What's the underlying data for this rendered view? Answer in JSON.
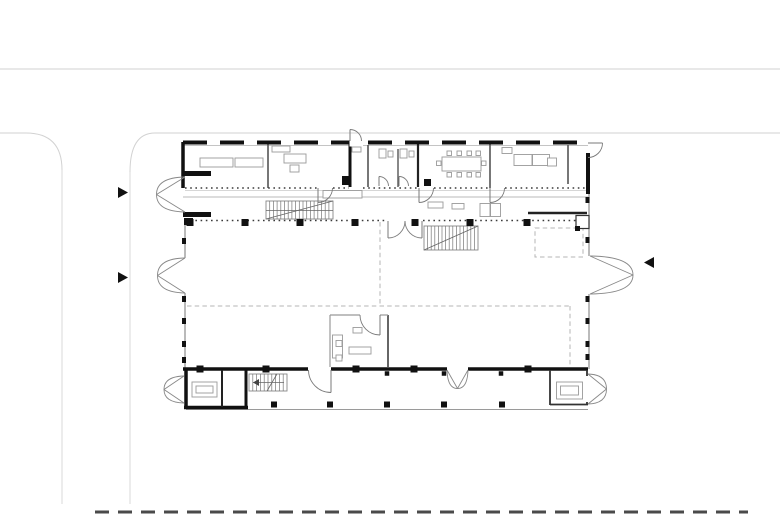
{
  "meta": {
    "kind": "architectural-floor-plan",
    "canvas": {
      "width": 780,
      "height": 515,
      "background": "#ffffff"
    },
    "colors": {
      "wall_black": "#111111",
      "wall_dark": "#222222",
      "wall_medium": "#555555",
      "wall_thin": "#8d8d8d",
      "line_light": "#b8b8b8",
      "site_line": "#d2d2d2",
      "guide_dash": "#b5b5b5",
      "door_line": "#7a7a7a",
      "furniture_line": "#9a9a9a",
      "site_dash_dark": "#4a4a4a"
    }
  },
  "site": {
    "lines": [
      {
        "n": "road-edge-top",
        "x1": 0,
        "y1": 69,
        "x2": 780,
        "y2": 69,
        "w": 1,
        "c": "#d2d2d2"
      },
      {
        "n": "road-edge-lower-left",
        "x1": 0,
        "y1": 133,
        "x2": 26,
        "y2": 133,
        "w": 1,
        "c": "#d2d2d2"
      },
      {
        "n": "road-edge-lower-right",
        "x1": 155,
        "y1": 133,
        "x2": 780,
        "y2": 133,
        "w": 1,
        "c": "#d2d2d2"
      },
      {
        "n": "driveway-edge-left",
        "x1": 62,
        "y1": 170,
        "x2": 62,
        "y2": 504,
        "w": 1,
        "c": "#d8d8d8"
      },
      {
        "n": "driveway-edge-right",
        "x1": 130,
        "y1": 172,
        "x2": 130,
        "y2": 504,
        "w": 1,
        "c": "#d8d8d8"
      }
    ],
    "curves": [
      {
        "n": "road-fillet-left",
        "d": "M26,133 Q62,133 62,170",
        "c": "#d2d2d2",
        "w": 1
      },
      {
        "n": "road-fillet-right",
        "d": "M155,133 Q130,133 130,172",
        "c": "#d2d2d2",
        "w": 1
      }
    ],
    "dashes": [
      {
        "n": "site-boundary-dashed",
        "x1": 95,
        "y1": 512,
        "x2": 748,
        "y2": 512,
        "w": 3,
        "c": "#4a4a4a",
        "dash": "14 9"
      }
    ]
  },
  "arrows": [
    {
      "n": "entrance-arrow-left-upper",
      "pts": "118,187 118,198 128,192.5"
    },
    {
      "n": "entrance-arrow-left-lower",
      "pts": "118,272 118,283 128,277.5"
    },
    {
      "n": "entrance-arrow-right",
      "pts": "654,257 654,268 644,262.5"
    }
  ],
  "plan": {
    "guides": [
      {
        "n": "void-guide-h",
        "x1": 187,
        "y1": 306,
        "x2": 570,
        "y2": 306
      },
      {
        "n": "void-guide-v",
        "x1": 380,
        "y1": 222,
        "x2": 380,
        "y2": 306
      },
      {
        "n": "void-guide-v2",
        "x1": 570,
        "y1": 306,
        "x2": 570,
        "y2": 368
      }
    ],
    "guide_rects": [
      {
        "n": "void-guide-rect",
        "x": 535,
        "y": 228,
        "w": 48,
        "h": 29
      }
    ],
    "thin_walls": [
      {
        "n": "facade-west-upper",
        "x1": 185,
        "y1": 218,
        "x2": 185,
        "y2": 258,
        "w": 1.2,
        "c": "#8d8d8d"
      },
      {
        "n": "facade-west-lower",
        "x1": 185,
        "y1": 293,
        "x2": 185,
        "y2": 369,
        "w": 1.2,
        "c": "#8d8d8d"
      },
      {
        "n": "facade-east-upper",
        "x1": 589,
        "y1": 194,
        "x2": 589,
        "y2": 256,
        "w": 1.2,
        "c": "#8d8d8d"
      },
      {
        "n": "facade-east-lower",
        "x1": 589,
        "y1": 294,
        "x2": 589,
        "y2": 369,
        "w": 1.2,
        "c": "#8d8d8d"
      },
      {
        "n": "wing-inner-face",
        "x1": 183,
        "y1": 145.5,
        "x2": 588,
        "y2": 145.5,
        "w": 0.8,
        "c": "#b0b0b0"
      },
      {
        "n": "wing-sill-line",
        "x1": 185,
        "y1": 190.5,
        "x2": 587,
        "y2": 190.5,
        "w": 0.7,
        "c": "#c8c8c8"
      },
      {
        "n": "gallery-edge",
        "x1": 183,
        "y1": 197,
        "x2": 588,
        "y2": 197,
        "w": 0.9,
        "c": "#b8b8b8"
      },
      {
        "n": "porch-edge",
        "x1": 186,
        "y1": 409.5,
        "x2": 588,
        "y2": 409.5,
        "w": 1,
        "c": "#9a9a9a"
      }
    ],
    "medium_walls": [
      {
        "n": "wing-partition-1",
        "x1": 268,
        "y1": 144,
        "x2": 268,
        "y2": 188,
        "w": 1.6,
        "c": "#555555"
      },
      {
        "n": "wc-partition-1",
        "x1": 368,
        "y1": 145,
        "x2": 368,
        "y2": 187,
        "w": 1.6,
        "c": "#555555"
      },
      {
        "n": "wc-partition-2",
        "x1": 398,
        "y1": 149,
        "x2": 398,
        "y2": 187,
        "w": 1.4,
        "c": "#555555"
      },
      {
        "n": "wing-partition-2",
        "x1": 490,
        "y1": 144,
        "x2": 490,
        "y2": 188,
        "w": 1.6,
        "c": "#555555"
      },
      {
        "n": "wing-partition-3",
        "x1": 568,
        "y1": 145,
        "x2": 568,
        "y2": 184,
        "w": 1.6,
        "c": "#555555"
      },
      {
        "n": "hall-office-wall-right",
        "x1": 388,
        "y1": 315,
        "x2": 388,
        "y2": 367,
        "w": 1.8,
        "c": "#555555"
      },
      {
        "n": "hall-office-wall-left",
        "x1": 330,
        "y1": 315,
        "x2": 330,
        "y2": 367,
        "w": 1.2,
        "c": "#999999"
      },
      {
        "n": "hall-office-wall-top-a",
        "x1": 330,
        "y1": 315,
        "x2": 360,
        "y2": 315,
        "w": 1.2,
        "c": "#999999"
      },
      {
        "n": "hall-office-wall-top-b",
        "x1": 380,
        "y1": 315,
        "x2": 388,
        "y2": 315,
        "w": 1.2,
        "c": "#999999"
      }
    ],
    "thick_walls": [
      {
        "n": "wing-west-wall",
        "x1": 183,
        "y1": 142,
        "x2": 183,
        "y2": 188,
        "w": 3.5,
        "c": "#111111"
      },
      {
        "n": "lobby-wall",
        "x1": 350,
        "y1": 142,
        "x2": 350,
        "y2": 187,
        "w": 3,
        "c": "#111111"
      },
      {
        "n": "core-wall",
        "x1": 418,
        "y1": 142,
        "x2": 418,
        "y2": 187,
        "w": 2.2,
        "c": "#222222"
      },
      {
        "n": "wing-east-wall",
        "x1": 588,
        "y1": 153,
        "x2": 588,
        "y2": 194,
        "w": 4,
        "c": "#111111"
      },
      {
        "n": "west-stub-upper",
        "x1": 183,
        "y1": 173.5,
        "x2": 211,
        "y2": 173.5,
        "w": 5,
        "c": "#111111"
      },
      {
        "n": "west-stub-lower",
        "x1": 183,
        "y1": 214.5,
        "x2": 211,
        "y2": 214.5,
        "w": 5,
        "c": "#111111"
      },
      {
        "n": "reception-wall",
        "x1": 528,
        "y1": 213,
        "x2": 587,
        "y2": 213,
        "w": 2.5,
        "c": "#222222"
      },
      {
        "n": "south-wall-a",
        "x1": 183,
        "y1": 369,
        "x2": 308,
        "y2": 369,
        "w": 3.5,
        "c": "#111111"
      },
      {
        "n": "south-wall-b",
        "x1": 331,
        "y1": 369,
        "x2": 447,
        "y2": 369,
        "w": 3.5,
        "c": "#111111"
      },
      {
        "n": "south-wall-c",
        "x1": 468,
        "y1": 369,
        "x2": 588,
        "y2": 369,
        "w": 3.5,
        "c": "#111111"
      },
      {
        "n": "bl-room-west",
        "x1": 186,
        "y1": 369,
        "x2": 186,
        "y2": 409,
        "w": 3.5,
        "c": "#111111"
      },
      {
        "n": "bl-room-south",
        "x1": 184,
        "y1": 407.5,
        "x2": 248,
        "y2": 407.5,
        "w": 3.5,
        "c": "#111111"
      },
      {
        "n": "bl-room-east",
        "x1": 246,
        "y1": 369,
        "x2": 246,
        "y2": 409,
        "w": 3,
        "c": "#111111"
      },
      {
        "n": "bl-room-divider",
        "x1": 222,
        "y1": 370,
        "x2": 222,
        "y2": 407,
        "w": 2,
        "c": "#222222"
      },
      {
        "n": "br-room-west",
        "x1": 550,
        "y1": 370,
        "x2": 550,
        "y2": 405,
        "w": 1.8,
        "c": "#333333"
      },
      {
        "n": "br-room-south",
        "x1": 550,
        "y1": 404.5,
        "x2": 588,
        "y2": 404.5,
        "w": 1.8,
        "c": "#333333"
      },
      {
        "n": "br-room-east-stub-a",
        "x1": 587,
        "y1": 370,
        "x2": 587,
        "y2": 376,
        "w": 1.8,
        "c": "#333333"
      },
      {
        "n": "br-room-east-stub-b",
        "x1": 587,
        "y1": 402,
        "x2": 587,
        "y2": 405,
        "w": 1.8,
        "c": "#333333"
      }
    ],
    "dashed_walls": [
      {
        "n": "wing-north-wall-dashed",
        "x1": 183,
        "y1": 142.5,
        "x2": 588,
        "y2": 142.5,
        "w": 4,
        "c": "#111111",
        "dash": "24 13"
      }
    ],
    "white_gaps": [
      {
        "n": "lobby-door-gap",
        "x": 349.5,
        "y": 137.5,
        "w": 13.5,
        "h": 9
      }
    ],
    "dotted_rows": [
      {
        "n": "wing-window-band",
        "y": 188,
        "segs": [
          [
            185,
            317
          ],
          [
            333,
            349
          ],
          [
            363,
            418
          ],
          [
            434,
            489
          ],
          [
            505,
            587
          ]
        ]
      },
      {
        "n": "gallery-glazing-band",
        "y": 220.5,
        "segs": [
          [
            185,
            387
          ],
          [
            423,
            588
          ]
        ]
      }
    ],
    "stairs": [
      {
        "n": "stair-gallery",
        "x": 266,
        "y": 201,
        "w": 67,
        "h": 18,
        "step": 3.7,
        "extras": [
          "M266,219 L333,201",
          "M266,210.5 L333,210.5"
        ]
      },
      {
        "n": "stair-hall",
        "x": 424,
        "y": 226,
        "w": 54,
        "h": 24,
        "step": 3.6,
        "extras": [
          "M424,250 L478,226"
        ]
      },
      {
        "n": "stair-small-south",
        "x": 249,
        "y": 374,
        "w": 38,
        "h": 17,
        "step": 3.8,
        "extras": [
          "M284,382.5 L253,382.5",
          "M267,391 L277,374"
        ],
        "arrow": "253,382.5 259,379 259,386"
      }
    ],
    "furniture": [
      {
        "n": "table",
        "x": 200,
        "y": 158,
        "w": 33,
        "h": 9
      },
      {
        "n": "table",
        "x": 235,
        "y": 158,
        "w": 28,
        "h": 9
      },
      {
        "n": "shelf",
        "x": 272,
        "y": 146,
        "w": 18,
        "h": 6
      },
      {
        "n": "desk",
        "x": 284,
        "y": 154,
        "w": 22,
        "h": 9
      },
      {
        "n": "chair",
        "x": 290,
        "y": 165,
        "w": 9,
        "h": 7
      },
      {
        "n": "fixture",
        "x": 352,
        "y": 147,
        "w": 9,
        "h": 5
      },
      {
        "n": "wc-fixture",
        "x": 379,
        "y": 149,
        "w": 7,
        "h": 9
      },
      {
        "n": "wc-fixture",
        "x": 388,
        "y": 151,
        "w": 5,
        "h": 6
      },
      {
        "n": "wc-fixture",
        "x": 400,
        "y": 149,
        "w": 7,
        "h": 9
      },
      {
        "n": "wc-fixture",
        "x": 409,
        "y": 151,
        "w": 5,
        "h": 6
      },
      {
        "n": "meeting-table",
        "x": 442,
        "y": 157,
        "w": 39,
        "h": 14
      },
      {
        "n": "chair",
        "x": 447,
        "y": 151,
        "w": 4.5,
        "h": 4.5
      },
      {
        "n": "chair",
        "x": 457,
        "y": 151,
        "w": 4.5,
        "h": 4.5
      },
      {
        "n": "chair",
        "x": 467,
        "y": 151,
        "w": 4.5,
        "h": 4.5
      },
      {
        "n": "chair",
        "x": 476,
        "y": 151,
        "w": 4.5,
        "h": 4.5
      },
      {
        "n": "chair",
        "x": 447,
        "y": 172.5,
        "w": 4.5,
        "h": 4.5
      },
      {
        "n": "chair",
        "x": 457,
        "y": 172.5,
        "w": 4.5,
        "h": 4.5
      },
      {
        "n": "chair",
        "x": 467,
        "y": 172.5,
        "w": 4.5,
        "h": 4.5
      },
      {
        "n": "chair",
        "x": 476,
        "y": 172.5,
        "w": 4.5,
        "h": 4.5
      },
      {
        "n": "chair",
        "x": 436.5,
        "y": 161,
        "w": 4.5,
        "h": 4.5
      },
      {
        "n": "chair",
        "x": 481.5,
        "y": 161,
        "w": 4.5,
        "h": 4.5
      },
      {
        "n": "shelf",
        "x": 502,
        "y": 147.5,
        "w": 10,
        "h": 6
      },
      {
        "n": "sofa",
        "x": 514,
        "y": 154.5,
        "w": 18,
        "h": 11
      },
      {
        "n": "sofa",
        "x": 532.5,
        "y": 154.5,
        "w": 17,
        "h": 11
      },
      {
        "n": "side-table",
        "x": 547.5,
        "y": 158,
        "w": 9,
        "h": 8
      },
      {
        "n": "bench",
        "x": 323,
        "y": 190.5,
        "w": 39,
        "h": 7.5
      },
      {
        "n": "bench",
        "x": 428,
        "y": 202,
        "w": 15,
        "h": 6
      },
      {
        "n": "bench",
        "x": 452,
        "y": 203.5,
        "w": 12,
        "h": 5.5
      },
      {
        "n": "reception-desk",
        "x": 480,
        "y": 203.5,
        "w": 10,
        "h": 13
      },
      {
        "n": "reception-desk",
        "x": 490.5,
        "y": 203.5,
        "w": 10,
        "h": 13
      },
      {
        "n": "office-desk-l",
        "x": 332.5,
        "y": 335,
        "w": 10,
        "h": 23
      },
      {
        "n": "office-desk",
        "x": 349,
        "y": 347,
        "w": 22,
        "h": 7
      },
      {
        "n": "chair",
        "x": 336,
        "y": 340.5,
        "w": 6,
        "h": 6
      },
      {
        "n": "chair",
        "x": 336,
        "y": 355,
        "w": 6,
        "h": 6
      },
      {
        "n": "cabinet",
        "x": 353,
        "y": 327.5,
        "w": 9,
        "h": 5.5
      },
      {
        "n": "table",
        "x": 192,
        "y": 382,
        "w": 25,
        "h": 15
      },
      {
        "n": "table-inner",
        "x": 196,
        "y": 386,
        "w": 17,
        "h": 7
      },
      {
        "n": "table",
        "x": 556.5,
        "y": 382,
        "w": 26,
        "h": 17
      },
      {
        "n": "table-inner",
        "x": 560.5,
        "y": 386,
        "w": 18,
        "h": 9
      }
    ],
    "outlined_boxes": [
      {
        "n": "shaft-box",
        "x": 576,
        "y": 215.5,
        "w": 13,
        "h": 13,
        "c": "#333333",
        "sw": 1.2
      }
    ],
    "single_doors": [
      {
        "n": "door-room-b",
        "leaf": "M318,188 L318,202.5",
        "arc": "M332.5,188 A14.5,14.5 0 0 1 318,202.5"
      },
      {
        "n": "door-meeting",
        "leaf": "M419,188 L419,202.5",
        "arc": "M433.5,188 A14.5,14.5 0 0 1 419,202.5"
      },
      {
        "n": "door-lounge",
        "leaf": "M490,188 L490,202.5",
        "arc": "M504.5,188 A14.5,14.5 0 0 1 490,202.5"
      },
      {
        "n": "door-wc-1",
        "leaf": "M379,186 L379,176.5",
        "arc": "M388.5,186 A9.5,9.5 0 0 0 379,176.5"
      },
      {
        "n": "door-wc-2",
        "leaf": "M399,186 L399,176.5",
        "arc": "M408.5,186 A9.5,9.5 0 0 0 399,176.5"
      },
      {
        "n": "door-lobby-exterior",
        "leaf": "M350,141 L350,129.5",
        "arc": "M350,129.5 A11.5,11.5 0 0 1 361.5,141"
      },
      {
        "n": "door-northeast-exterior",
        "leaf": "M588,143 L602.5,143",
        "arc": "M602.5,143 A14.5,14.5 0 0 1 588,157.5"
      },
      {
        "n": "door-hall-office",
        "leaf": "M380,315 L380,335",
        "arc": "M360,315 A20,20 0 0 0 380,335"
      },
      {
        "n": "door-porch-single",
        "leaf": "M331,370 L331,392.5",
        "arc": "M308.5,370 A22.5,22.5 0 0 0 331,392.5"
      },
      {
        "n": "door-gallery-hall-left",
        "leaf": "M388,221 L388,238",
        "arc": "M405,221 A17,17 0 0 1 388,238"
      },
      {
        "n": "door-gallery-hall-right",
        "leaf": "M422,221 L422,238",
        "arc": "M405,221 A17,17 0 0 0 422,238"
      }
    ],
    "double_doors": [
      {
        "n": "door-west-upper",
        "paths": [
          "M185,177 Q156.5,177.5 156.5,194.5",
          "M185,212 Q156.5,211.5 156.5,194.5",
          "M185,177 L156.5,194.5",
          "M185,212 L156.5,194.5"
        ]
      },
      {
        "n": "door-west-lower",
        "paths": [
          "M185,258 Q157.5,258.5 157.5,275.5",
          "M185,293 Q157.5,292.5 157.5,275.5",
          "M185,258 L157.5,275.5",
          "M185,293 L157.5,275.5"
        ]
      },
      {
        "n": "door-east-main",
        "paths": [
          "M590,256 Q633,256.5 633,275",
          "M590,294 Q633,293.5 633,275",
          "M590,256 L633,275",
          "M590,294 L633,275"
        ]
      },
      {
        "n": "door-porch-double",
        "paths": [
          "M447,370 Q447.5,388.5 457.5,388.5",
          "M468,370 Q467.5,388.5 457.5,388.5",
          "M447,370 L457.5,388.5",
          "M468,370 L457.5,388.5"
        ]
      },
      {
        "n": "door-bl-room",
        "paths": [
          "M184,376 Q164,376.5 164,389.5",
          "M184,403 Q164,402.5 164,389.5",
          "M184,376 L164,389.5",
          "M184,403 L164,389.5"
        ]
      },
      {
        "n": "door-br-room",
        "paths": [
          "M588,374 Q606.5,374.5 606.5,389",
          "M588,404 Q606.5,403.5 606.5,389",
          "M588,374 L606.5,389",
          "M588,404 L606.5,389"
        ]
      }
    ],
    "columns": {
      "gallery_row": {
        "y": 222.5,
        "s": 7,
        "xs": [
          190,
          245,
          300,
          355,
          415,
          470,
          527
        ]
      },
      "south_wall_row": {
        "y": 369,
        "s": 7,
        "xs": [
          200,
          266,
          356,
          414,
          528
        ]
      },
      "porch_row": {
        "y": 404.5,
        "s": 6,
        "xs": [
          274,
          330,
          387,
          444,
          502
        ]
      },
      "sub_ticks": {
        "y": 373.5,
        "s": 4.5,
        "xs": [
          387,
          444,
          501
        ]
      }
    },
    "facade_ticks": {
      "left": {
        "x": 184,
        "ys": [
          241,
          299,
          321,
          344,
          360
        ]
      },
      "right": {
        "x": 587.5,
        "ys": [
          200,
          240,
          299,
          321,
          344,
          357
        ]
      }
    },
    "black_boxes": [
      {
        "n": "shaft-solid",
        "x": 342,
        "y": 176,
        "w": 9,
        "h": 9
      },
      {
        "n": "column-solid",
        "x": 424,
        "y": 179,
        "w": 7,
        "h": 7
      },
      {
        "n": "column-solid",
        "x": 184,
        "y": 218,
        "w": 9,
        "h": 7
      },
      {
        "n": "shaft-corner",
        "x": 575,
        "y": 226,
        "w": 5,
        "h": 5
      }
    ]
  }
}
